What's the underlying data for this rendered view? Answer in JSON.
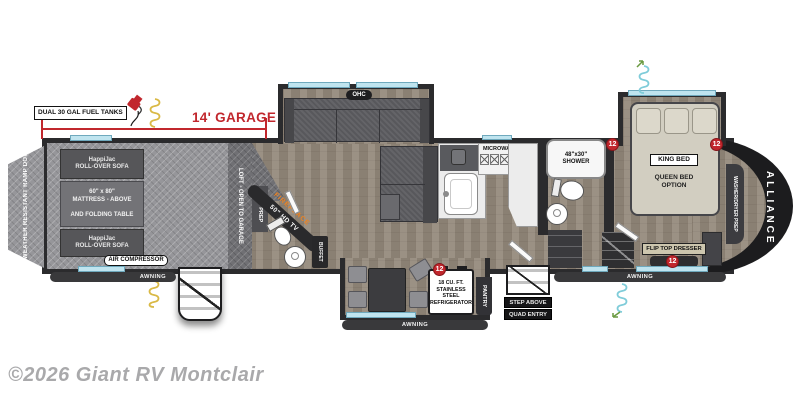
{
  "watermark": "©2026 Giant RV Montclair",
  "brand": "ALLIANCE",
  "marker_label": "12",
  "awning": "AWNING",
  "top": {
    "fuel_tanks": "DUAL 30 GAL FUEL TANKS",
    "garage_dim": "14' GARAGE"
  },
  "garage": {
    "ramp_door": "8' WEATHER RESISTANT RAMP DOOR",
    "sofa_l1": "HappiJac",
    "sofa_l2": "ROLL-OVER SOFA",
    "mattress_l1": "60\" x 80\"",
    "mattress_l2": "MATTRESS - ABOVE",
    "mattress_l3": "AND FOLDING TABLE",
    "air_compressor": "AIR COMPRESSOR",
    "loft": "LOFT - OPEN TO GARAGE",
    "wd_prep": "W/D PREP"
  },
  "living": {
    "ohc": "OHC",
    "fireplace": "FIREPLACE",
    "tv": "50\" HD TV",
    "buffet": "BUFFET"
  },
  "kitchen": {
    "microwave": "MICROWAVE",
    "fridge_l1": "18 CU. FT.",
    "fridge_l2": "STAINLESS STEEL",
    "fridge_l3": "REFRIGERATOR",
    "pantry": "PANTRY"
  },
  "bath": {
    "shower_l1": "48\"x30\"",
    "shower_l2": "SHOWER"
  },
  "entry": {
    "step_l1": "STEP ABOVE",
    "step_l2": "QUAD ENTRY"
  },
  "bedroom": {
    "king": "KING BED",
    "queen_l1": "QUEEN BED",
    "queen_l2": "OPTION",
    "dresser": "FLIP TOP DRESSER",
    "wd": "WASHER/DRYER PREP"
  },
  "colors": {
    "red": "#c1272d",
    "teal": "#bfe4ef",
    "orange": "#f0821e",
    "wall": "#2b2b2d"
  }
}
